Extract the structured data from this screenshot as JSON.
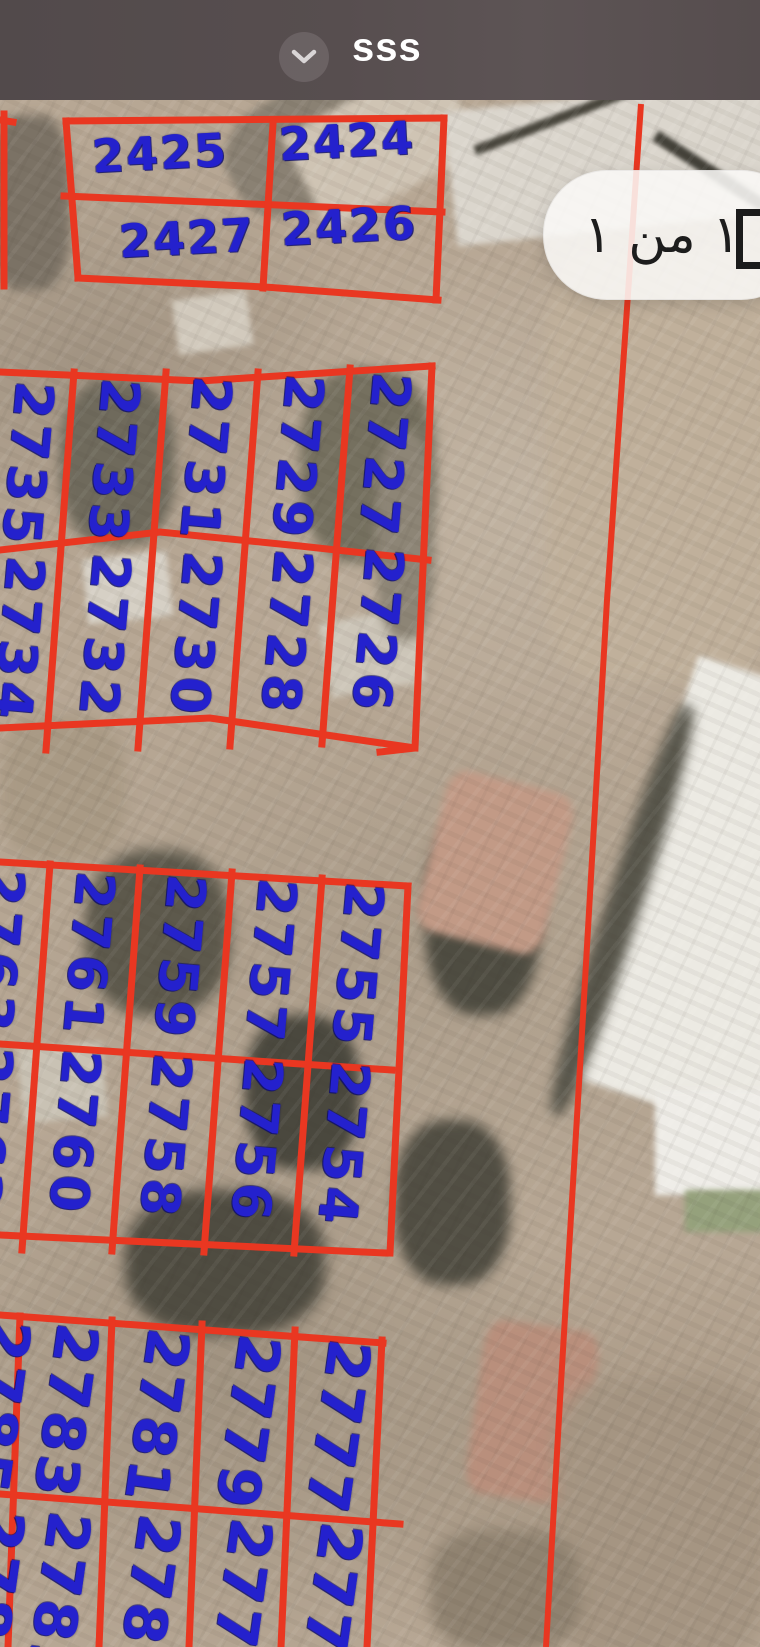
{
  "header": {
    "title": "sss"
  },
  "page_badge": {
    "text": "١ من ١"
  },
  "map": {
    "type": "satellite-cadastral",
    "parcel_line_color": "#e93721",
    "plot_number_color": "#2421cd",
    "plots": {
      "topA": [
        "2425",
        "2424"
      ],
      "topB": [
        "2427",
        "2426"
      ],
      "midA": [
        "2735",
        "2733",
        "2731",
        "2729",
        "2727"
      ],
      "midB": [
        "2734",
        "2732",
        "2730",
        "2728",
        "2726"
      ],
      "lowA": [
        "2763",
        "2761",
        "2759",
        "2757",
        "2755"
      ],
      "lowB": [
        "2762",
        "2760",
        "2758",
        "2756",
        "2754"
      ],
      "botA": [
        "2785",
        "2783",
        "2781",
        "2779",
        "2777"
      ],
      "botB": [
        "2784",
        "2782",
        "2780",
        "2778",
        "2776"
      ]
    }
  }
}
